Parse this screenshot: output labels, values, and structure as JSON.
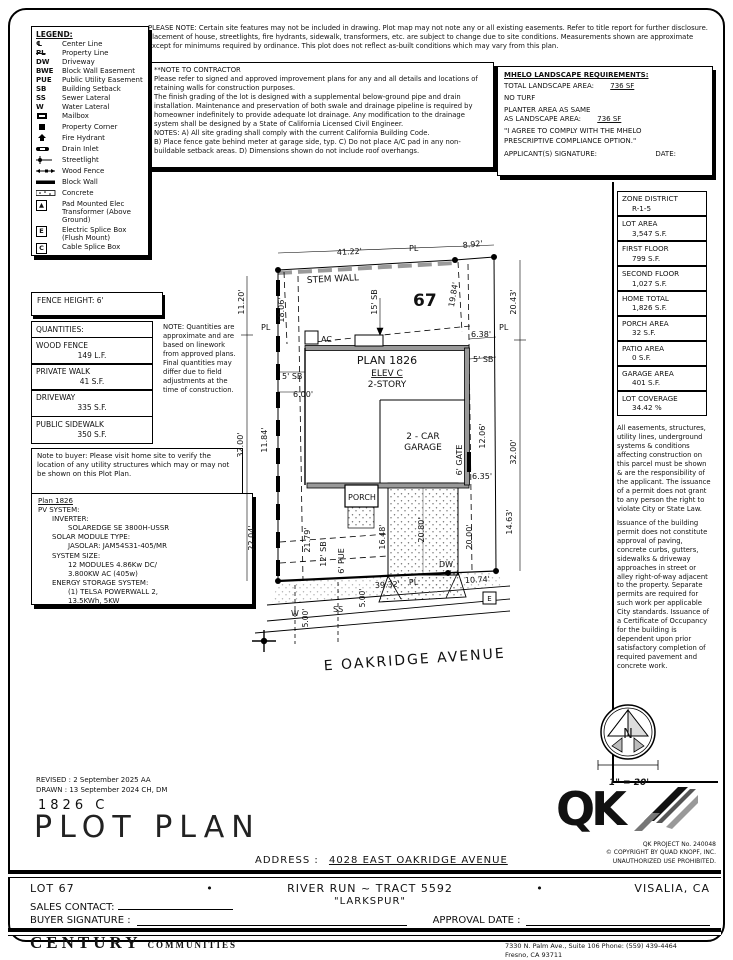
{
  "notes": {
    "please_note": "PLEASE NOTE:  Certain site features may not be included in drawing.  Plot map may not note any or all existing easements. Refer to title report for further disclosure.  Placement of house, streetlights, fire hydrants, sidewalk, transformers, etc. are subject to change due to site conditions.  Measurements shown are approximate except for minimums required by ordinance.  This plot does not reflect as-built conditions which may vary from this plan.",
    "contractor_title": "**NOTE TO CONTRACTOR",
    "contractor_p1": "Please refer to signed and approved improvement plans for any and all details and locations of retaining walls for construction purposes.",
    "contractor_p2": "The finish grading of the lot is designed with a supplemental below-ground pipe and drain installation.  Maintenance and preservation of both swale and drainage pipeline is required by homeowner indefinitely to provide adequate lot drainage.  Any modification to the drainage system shall be designed by a State of California Licensed Civil Engineer.",
    "contractor_p3": "NOTES:  A) All site grading shall comply with the current California Building Code.",
    "contractor_p4": "B) Place fence gate behind meter at garage side, typ.  C) Do not place A/C pad in any non-buildable setback areas.  D) Dimensions shown do not include roof overhangs."
  },
  "mhelo": {
    "title": "MHELO LANDSCAPE REQUIREMENTS:",
    "total_label": "TOTAL LANDSCAPE AREA:",
    "total_value": "736 SF",
    "no_turf": "NO TURF",
    "planter_l1": "PLANTER AREA AS SAME",
    "planter_l2": "AS LANDSCAPE AREA:",
    "planter_value": "736 SF",
    "agree_l1": "\"I AGREE TO COMPLY WITH THE MHELO",
    "agree_l2": "PRESCRIPTIVE COMPLIANCE OPTION.\"",
    "sig_label": "APPLICANT(S) SIGNATURE:",
    "date_label": "DATE:"
  },
  "legend": {
    "title": "LEGEND:",
    "items": [
      {
        "sym": "℄",
        "label": "Center Line"
      },
      {
        "sym": "PL",
        "label": "Property Line"
      },
      {
        "sym": "DW",
        "label": "Driveway"
      },
      {
        "sym": "BWE",
        "label": "Block Wall Easement"
      },
      {
        "sym": "PUE",
        "label": "Public Utility Easement"
      },
      {
        "sym": "SB",
        "label": "Building Setback"
      },
      {
        "sym": "SS",
        "label": "Sewer Lateral"
      },
      {
        "sym": "W",
        "label": "Water Lateral"
      },
      {
        "sym": "",
        "label": "Mailbox"
      },
      {
        "sym": "",
        "label": "Property Corner"
      },
      {
        "sym": "",
        "label": "Fire Hydrant"
      },
      {
        "sym": "",
        "label": "Drain Inlet"
      },
      {
        "sym": "",
        "label": "Streetlight"
      },
      {
        "sym": "",
        "label": "Wood Fence"
      },
      {
        "sym": "",
        "label": "Block Wall"
      },
      {
        "sym": "",
        "label": "Concrete"
      },
      {
        "sym": "▲",
        "label": "Pad Mounted Elec Transformer (Above Ground)"
      },
      {
        "sym": "E",
        "label": "Electric Splice Box (Flush Mount)"
      },
      {
        "sym": "C",
        "label": "Cable Splice Box"
      }
    ]
  },
  "fence_height": "FENCE HEIGHT: 6'",
  "quantities": {
    "title": "QUANTITIES:",
    "rows": [
      {
        "name": "WOOD FENCE",
        "value": "149 L.F."
      },
      {
        "name": "PRIVATE WALK",
        "value": "41 S.F."
      },
      {
        "name": "DRIVEWAY",
        "value": "335 S.F."
      },
      {
        "name": "PUBLIC SIDEWALK",
        "value": "350 S.F."
      }
    ],
    "note": "NOTE: Quantities are approximate and are based on linework from approved plans.  Final quantities may differ due to field adjustments at the time of construction."
  },
  "buyer_note": "Note to buyer: Please visit home site to verify the location of any utility structures which may or may not be shown on this Plot Plan.",
  "pv": {
    "title": "Plan 1826",
    "lines": [
      "PV SYSTEM:",
      "INVERTER:",
      "SOLAREDGE SE 3800H-USSR",
      "SOLAR MODULE TYPE:",
      "JASOLAR: JAM54S31-405/MR",
      "SYSTEM SIZE:",
      "12 MODULES 4.86Kw DC/",
      "3.800KW AC (405w)",
      "ENERGY STORAGE SYSTEM:",
      "(1) TELSA POWERWALL 2,",
      "13.5KWh, 5KW"
    ]
  },
  "zone_table": {
    "rows": [
      {
        "label": "ZONE DISTRICT",
        "value": "R-1-5"
      },
      {
        "label": "LOT AREA",
        "value": "3,547 S.F."
      },
      {
        "label": "FIRST FLOOR",
        "value": "799 S.F."
      },
      {
        "label": "SECOND FLOOR",
        "value": "1,027 S.F."
      },
      {
        "label": "HOME TOTAL",
        "value": "1,826 S.F."
      },
      {
        "label": "PORCH AREA",
        "value": "32 S.F."
      },
      {
        "label": "PATIO AREA",
        "value": "0 S.F."
      },
      {
        "label": "GARAGE AREA",
        "value": "401 S.F."
      },
      {
        "label": "LOT COVERAGE",
        "value": "34.42 %"
      }
    ]
  },
  "right_disclaimer": {
    "p1": "All easements, structures, utility lines, underground systems & conditions affecting construction on this parcel must be shown & are the responsibility of the applicant. The issuance of a permit does not grant to any person the right to violate City or State Law.",
    "p2": "Issuance of the building permit does not constitute approval of paving, concrete curbs, gutters, sidewalks & driveway approaches in street or alley right-of-way adjacent to the property. Separate permits are required for such work per applicable City standards. Issuance of a Certificate of Occupancy for the building is dependent upon prior satisfactory completion of required pavement and concrete work."
  },
  "compass": {
    "n": "N",
    "scale": "1\" = 20'"
  },
  "plot": {
    "lot_number": "67",
    "street_name": "E OAKRIDGE AVENUE",
    "stem_wall": "STEM WALL",
    "plan_title": "PLAN 1826",
    "plan_elev": "ELEV C",
    "plan_story": "2-STORY",
    "garage_l1": "2 - CAR",
    "garage_l2": "GARAGE",
    "porch": "PORCH",
    "ac": "AC",
    "dw": "DW",
    "w": "W",
    "ss": "SS",
    "e_box": "E",
    "pl": "PL",
    "dims": {
      "d4122": "41.22'",
      "d892": "8.92'",
      "d1120": "11.20'",
      "d1806": "18.06'",
      "sb15": "15' SB",
      "d1984": "19.84'",
      "d2043": "20.43'",
      "d638": "6.38'",
      "sb5r": "5' SB",
      "sb5l": "5' SB",
      "d600": "6.00'",
      "d3200l": "32.00'",
      "d1184": "11.84'",
      "d3200r": "32.00'",
      "d1206": "12.06'",
      "gate6": "6' GATE",
      "d635": "6.35'",
      "d2204": "22.04'",
      "d2179": "21.79'",
      "sb12": "12' SB",
      "pue6": "6' PUE",
      "d1648": "16.48'",
      "d2080": "20.80'",
      "d2000": "20.00'",
      "d1463": "14.63'",
      "d3932": "39.32'",
      "d1074": "10.74'",
      "d500a": "5.00'",
      "d500b": "5.00'"
    }
  },
  "titleblock": {
    "revised": "REVISED :  2 September 2025  AA",
    "drawn": "DRAWN :  13 September 2024  CH, DM",
    "plan_code": "1826  C",
    "title": "PLOT PLAN",
    "address_label": "ADDRESS :",
    "address_value": "4028 EAST OAKRIDGE AVENUE",
    "lot": "LOT 67",
    "bullet": "•",
    "tract": "RIVER RUN ~ TRACT 5592",
    "community": "\"LARKSPUR\"",
    "city": "VISALIA, CA",
    "sales_label": "SALES CONTACT:",
    "buyer_label": "BUYER SIGNATURE :",
    "approval_label": "APPROVAL DATE :",
    "qk_letters": "QK",
    "qk_project": "QK PROJECT No. 240048",
    "qk_copyright": "©  COPYRIGHT BY QUAD KNOPF, INC.",
    "qk_unauthorized": "UNAUTHORIZED USE PROHIBITED.",
    "brand1": "CENTURY",
    "brand2": "COMMUNITIES",
    "addr1": "7330 N. Palm Ave., Suite 106    Phone:  (559) 439-4464",
    "addr2": "Fresno, CA  93711"
  }
}
